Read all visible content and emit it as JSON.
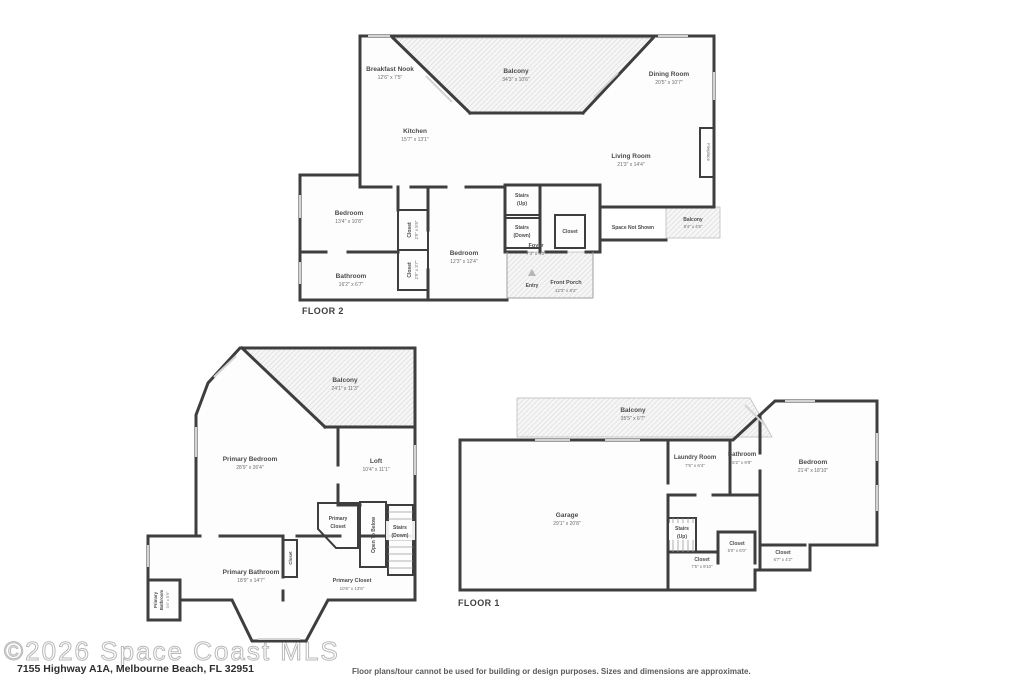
{
  "meta": {
    "watermark": "©2026 Space Coast MLS",
    "address": "7155 Highway A1A, Melbourne Beach, FL 32951",
    "disclaimer": "Floor plans/tour cannot be used for building or design purposes. Sizes and dimensions are approximate.",
    "wall_color": "#3e3e3e",
    "hatch_color": "#e1e1e1"
  },
  "floor2": {
    "label": "FLOOR 2",
    "rooms": {
      "breakfast_nook": {
        "name": "Breakfast Nook",
        "dims": "12'6\" x 7'5\""
      },
      "balcony": {
        "name": "Balcony",
        "dims": "34'3\" x 10'6\""
      },
      "dining_room": {
        "name": "Dining Room",
        "dims": "20'5\" x 10'7\""
      },
      "kitchen": {
        "name": "Kitchen",
        "dims": "15'7\" x 13'1\""
      },
      "living_room": {
        "name": "Living Room",
        "dims": "21'3\" x 14'4\""
      },
      "fireplace": {
        "name": "Fireplace"
      },
      "bedroom_left": {
        "name": "Bedroom",
        "dims": "13'4\" x 10'8\""
      },
      "bedroom_center": {
        "name": "Bedroom",
        "dims": "12'3\" x 12'4\""
      },
      "bathroom": {
        "name": "Bathroom",
        "dims": "16'2\" x 6'7\""
      },
      "closet_top": {
        "name": "Closet",
        "dims": "2'9\" x 5'5\""
      },
      "closet_bottom": {
        "name": "Closet",
        "dims": "2'9\" x 3'7\""
      },
      "stairs_up": {
        "name": "Stairs",
        "sub": "(Up)"
      },
      "stairs_down": {
        "name": "Stairs",
        "sub": "(Down)"
      },
      "closet_foyer": {
        "name": "Closet"
      },
      "foyer": {
        "name": "Foyer",
        "dims": "7'3\" x 4'2\""
      },
      "space_not_shown": {
        "name": "Space Not Shown"
      },
      "balcony_side": {
        "name": "Balcony",
        "dims": "8'4\" x 4'5\""
      },
      "entry": {
        "name": "Entry"
      },
      "front_porch": {
        "name": "Front Porch",
        "dims": "12'3\" x 8'2\""
      }
    }
  },
  "floor3": {
    "rooms": {
      "balcony": {
        "name": "Balcony",
        "dims": "24'1\" x 11'3\""
      },
      "primary_bedroom": {
        "name": "Primary Bedroom",
        "dims": "28'9\" x 26'4\""
      },
      "loft": {
        "name": "Loft",
        "dims": "10'4\" x 11'1\""
      },
      "primary_closet_upper": {
        "line1": "Primary",
        "line2": "Closet"
      },
      "open_to_below": {
        "name": "Open To Below"
      },
      "stairs_down": {
        "name": "Stairs",
        "sub": "(Down)"
      },
      "primary_bathroom": {
        "name": "Primary Bathroom",
        "dims": "18'9\" x 14'7\""
      },
      "primary_bathroom_small": {
        "line1": "Primary",
        "line2": "Bathroom",
        "dims": "3'4\" x 5'9\""
      },
      "closet_small": {
        "name": "Closet"
      },
      "primary_closet": {
        "name": "Primary Closet",
        "dims": "10'6\" x 13'6\""
      }
    }
  },
  "floor1": {
    "label": "FLOOR 1",
    "rooms": {
      "balcony": {
        "name": "Balcony",
        "dims": "35'5\" x 6'7\""
      },
      "laundry": {
        "name": "Laundry Room",
        "dims": "7'5\" x 6'4\""
      },
      "bathroom": {
        "name": "Bathroom",
        "dims": "5'2\" x 9'9\""
      },
      "bedroom": {
        "name": "Bedroom",
        "dims": "21'4\" x 18'10\""
      },
      "garage": {
        "name": "Garage",
        "dims": "29'1\" x 20'8\""
      },
      "stairs_up": {
        "name": "Stairs",
        "sub": "(Up)"
      },
      "closet_a": {
        "name": "Closet",
        "dims": "7'5\" x 9'10\""
      },
      "closet_b": {
        "name": "Closet",
        "dims": "5'0\" x 6'0\""
      },
      "closet_c": {
        "name": "Closet",
        "dims": "6'7\" x 4'2\""
      }
    }
  }
}
